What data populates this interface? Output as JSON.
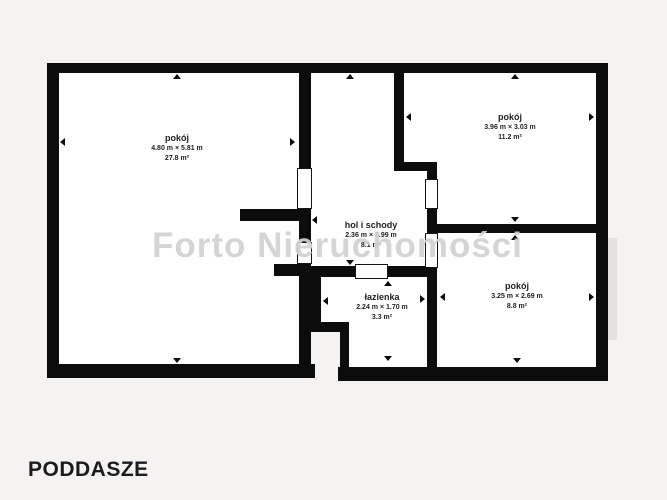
{
  "page": {
    "background": "#f4f3f1",
    "wall_color": "#0c0c0c",
    "floor_color": "#ffffff"
  },
  "watermark": {
    "text": "Forto Nieruchomości",
    "color": "#d2d2d2"
  },
  "floor_label": {
    "text": "PODDASZE"
  },
  "rooms": [
    {
      "id": "room-left",
      "name": "pokój",
      "dimensions": "4.80 m × 5.81 m",
      "area": "27.8 m²"
    },
    {
      "id": "room-top-right",
      "name": "pokój",
      "dimensions": "3.96 m × 3.03 m",
      "area": "11.2 m²"
    },
    {
      "id": "hall-stairs",
      "name": "hol i schody",
      "dimensions": "2.36 m × 3.99 m",
      "area": "8.1 m²"
    },
    {
      "id": "bathroom",
      "name": "łazienka",
      "dimensions": "2.24 m × 1.70 m",
      "area": "3.3 m²"
    },
    {
      "id": "room-bottom-right",
      "name": "pokój",
      "dimensions": "3.25 m × 2.69 m",
      "area": "8.8 m²"
    }
  ]
}
